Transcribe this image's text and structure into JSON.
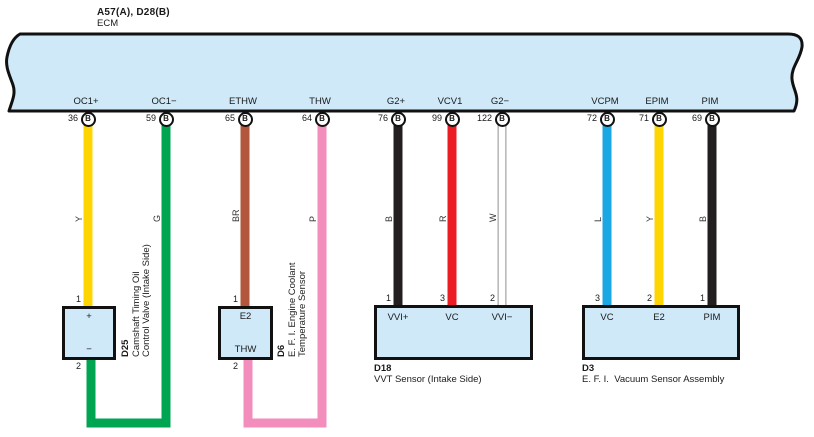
{
  "ecm": {
    "code_label": "A57(A), D28(B)",
    "name": "ECM"
  },
  "colors": {
    "panel_fill": "#cfe9f9",
    "outline": "#111111",
    "white_wire_edge": "#a8a8a8",
    "white_wire_fill": "#ffffff"
  },
  "terminals": [
    {
      "name": "OC1+",
      "pin": "36",
      "connector": "B",
      "wire_label": "Y",
      "wire_hex": "#fed402",
      "x": 88,
      "route": null
    },
    {
      "name": "OC1−",
      "pin": "59",
      "connector": "B",
      "wire_label": "G",
      "wire_hex": "#00a551",
      "x": 166,
      "route": {
        "bottom_y": 423,
        "left_to": 91,
        "up_to": 356
      }
    },
    {
      "name": "ETHW",
      "pin": "65",
      "connector": "B",
      "wire_label": "BR",
      "wire_hex": "#b2573b",
      "x": 245,
      "route": null
    },
    {
      "name": "THW",
      "pin": "64",
      "connector": "B",
      "wire_label": "P",
      "wire_hex": "#f28dbc",
      "x": 322,
      "route": {
        "bottom_y": 423,
        "left_to": 248,
        "up_to": 356
      }
    },
    {
      "name": "G2+",
      "pin": "76",
      "connector": "B",
      "wire_label": "B",
      "wire_hex": "#231f20",
      "x": 398,
      "route": null
    },
    {
      "name": "VCV1",
      "pin": "99",
      "connector": "B",
      "wire_label": "R",
      "wire_hex": "#ec1c24",
      "x": 452,
      "route": null
    },
    {
      "name": "G2−",
      "pin": "122",
      "connector": "B",
      "wire_label": "W",
      "wire_hex": "#ffffff",
      "x": 502,
      "route": null,
      "outlined": true
    },
    {
      "name": "VCPM",
      "pin": "72",
      "connector": "B",
      "wire_label": "L",
      "wire_hex": "#1ba7e3",
      "x": 607,
      "route": null
    },
    {
      "name": "EPIM",
      "pin": "71",
      "connector": "B",
      "wire_label": "Y",
      "wire_hex": "#fed402",
      "x": 659,
      "route": null
    },
    {
      "name": "PIM",
      "pin": "69",
      "connector": "B",
      "wire_label": "B",
      "wire_hex": "#231f20",
      "x": 712,
      "route": null
    }
  ],
  "components": [
    {
      "id": "D25",
      "type": "small",
      "box": {
        "x": 62,
        "y": 306,
        "w": 54,
        "h": 54
      },
      "inner_top": "+",
      "inner_bottom": "−",
      "pin_top": {
        "num": "1",
        "x": 88
      },
      "pin_bottom": {
        "num": "2",
        "x": 91
      },
      "vlabel": {
        "x": 121,
        "y": 357,
        "lines": [
          "D25",
          "Camshaft Timing Oil",
          "Control Valve (Intake Side)"
        ]
      }
    },
    {
      "id": "D6",
      "type": "small",
      "box": {
        "x": 218,
        "y": 306,
        "w": 55,
        "h": 54
      },
      "inner_top": "E2",
      "inner_bottom": "THW",
      "pin_top": {
        "num": "1",
        "x": 245
      },
      "pin_bottom": {
        "num": "2",
        "x": 248
      },
      "vlabel": {
        "x": 277,
        "y": 357,
        "lines": [
          "D6",
          "E. F. I. Engine Coolant",
          "Temperature Sensor"
        ]
      }
    },
    {
      "id": "D18",
      "type": "wide",
      "box": {
        "x": 374,
        "y": 305,
        "w": 159,
        "h": 55
      },
      "pins": [
        {
          "num": "1",
          "x": 398,
          "label": "VVI+"
        },
        {
          "num": "3",
          "x": 452,
          "label": "VC"
        },
        {
          "num": "2",
          "x": 502,
          "label": "VVI−"
        }
      ],
      "caption": [
        "D18",
        "VVT Sensor (Intake Side)"
      ]
    },
    {
      "id": "D3",
      "type": "wide",
      "box": {
        "x": 582,
        "y": 305,
        "w": 158,
        "h": 55
      },
      "pins": [
        {
          "num": "3",
          "x": 607,
          "label": "VC"
        },
        {
          "num": "2",
          "x": 659,
          "label": "E2"
        },
        {
          "num": "1",
          "x": 712,
          "label": "PIM"
        }
      ],
      "caption": [
        "D3",
        "E. F. I.  Vacuum Sensor Assembly"
      ]
    }
  ]
}
